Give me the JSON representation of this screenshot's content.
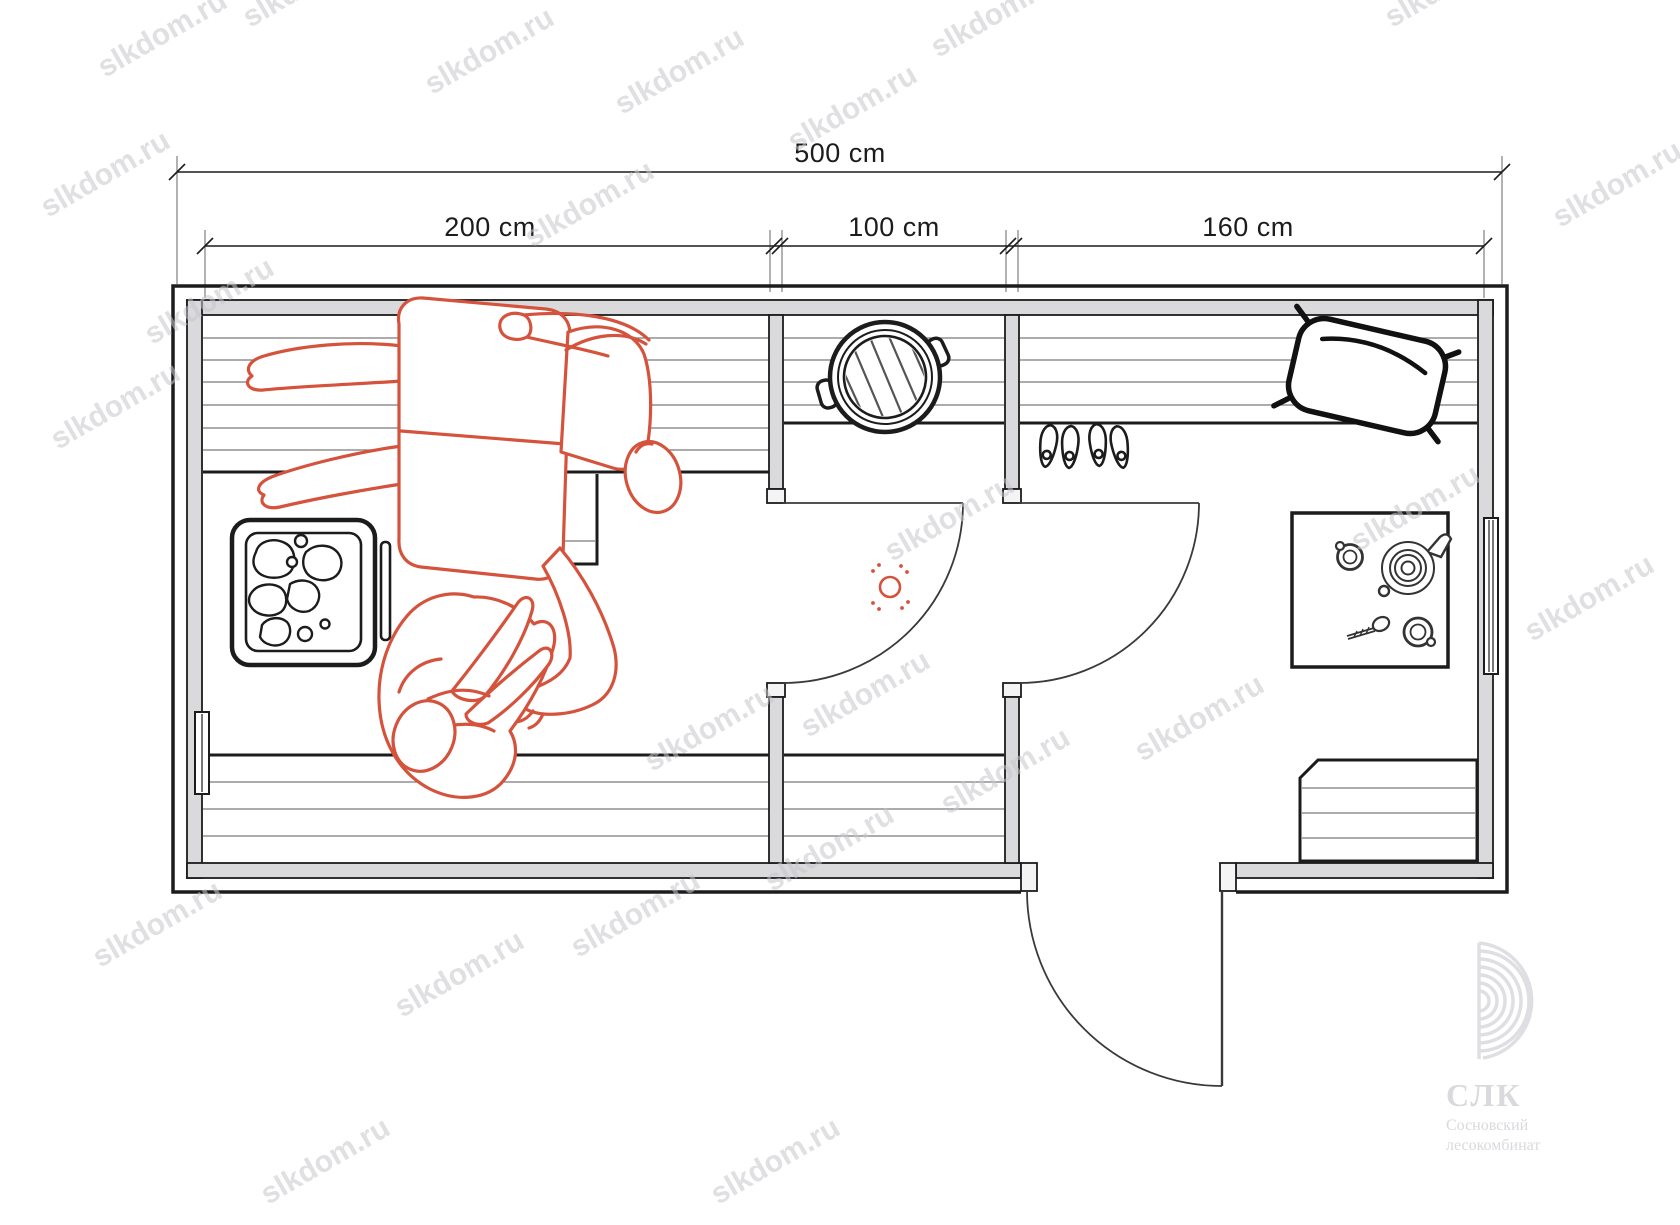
{
  "page": {
    "type": "sauna-floor-plan",
    "background": "#ffffff"
  },
  "watermark": {
    "text": "slkdom.ru",
    "color": "#c7c7cd"
  },
  "dimensions": {
    "unit": "cm",
    "total": {
      "label": "500 cm",
      "value": 500
    },
    "rooms": [
      {
        "id": "steam-room",
        "label": "200 cm",
        "value": 200
      },
      {
        "id": "wash-room",
        "label": "100 cm",
        "value": 100
      },
      {
        "id": "rest-room",
        "label": "160 cm",
        "value": 160
      }
    ]
  },
  "logo": {
    "abbr": "СЛК",
    "line1": "Сосновский",
    "line2": "лесокомбинат",
    "color": "#d9d9de"
  },
  "colors": {
    "wall_fill": "#dadadc",
    "outline": "#1c1c1c",
    "plank_line": "#7b7b7b",
    "figure_outline": "#d5523c",
    "watermark": "#c7c7cd"
  },
  "plan_elements": [
    "outer-walls",
    "partition-walls",
    "left-window",
    "right-window",
    "sauna-stove",
    "stove-stones",
    "stove-guard-rail",
    "upper-benches",
    "lower-benches",
    "bench-step",
    "lying-person",
    "sitting-person",
    "wash-tub",
    "floor-drain",
    "interior-door-swings",
    "entrance-door-swing",
    "slippers",
    "pillow",
    "tea-table",
    "teapot",
    "tea-cups",
    "spoon",
    "corner-bench"
  ]
}
